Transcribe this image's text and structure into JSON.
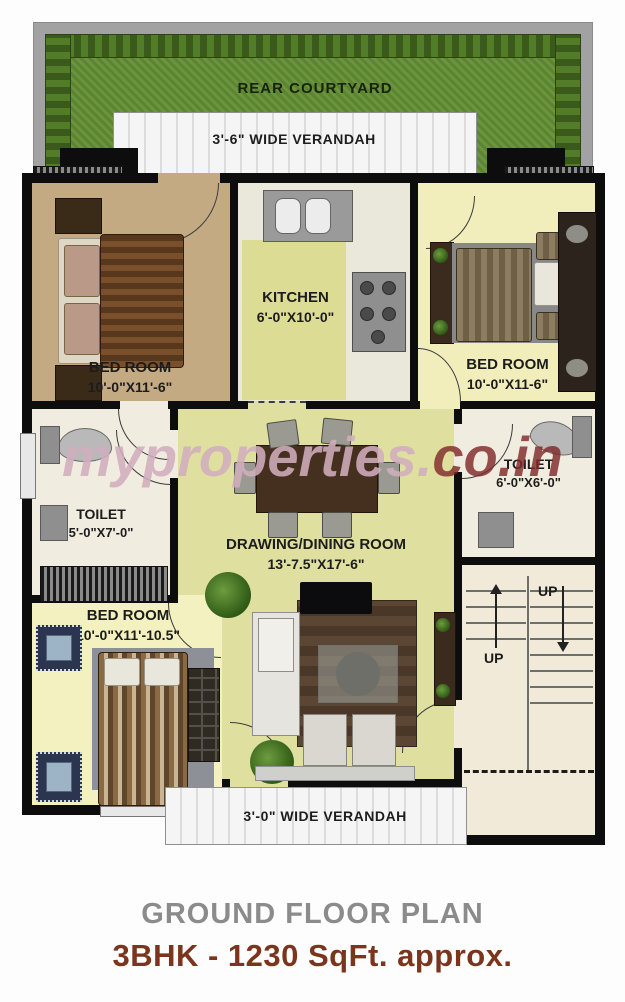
{
  "watermark": {
    "part1": "myproperties.",
    "part2": "co.in"
  },
  "rooms": {
    "rear_courtyard": {
      "name": "REAR COURTYARD"
    },
    "top_verandah": {
      "name": "3'-6\" WIDE VERANDAH"
    },
    "bottom_verandah": {
      "name": "3'-0\" WIDE VERANDAH"
    },
    "bedroom_top_left": {
      "name": "BED ROOM",
      "dims": "10'-0\"X11'-6\""
    },
    "kitchen": {
      "name": "KITCHEN",
      "dims": "6'-0\"X10'-0\""
    },
    "bedroom_top_right": {
      "name": "BED ROOM",
      "dims": "10'-0\"X11-6\""
    },
    "toilet_left": {
      "name": "TOILET",
      "dims": "5'-0\"X7'-0\""
    },
    "toilet_right": {
      "name": "TOILET",
      "dims": "6'-0\"X6'-0\""
    },
    "drawing_dining": {
      "name": "DRAWING/DINING ROOM",
      "dims": "13'-7.5\"X17'-6\""
    },
    "bedroom_bottom_left": {
      "name": "BED ROOM",
      "dims": "10'-0\"X11'-10.5\""
    },
    "stairs": {
      "up1": "UP",
      "up2": "UP"
    }
  },
  "footer": {
    "title": "GROUND FLOOR PLAN",
    "subtitle": "3BHK - 1230 SqFt. approx."
  },
  "colors": {
    "grass": "#67913a",
    "floor_tan": "#c3aa82",
    "floor_pale_yellow": "#f2eebb",
    "floor_yellow_green": "#dfe0a0",
    "floor_cream": "#f1ece0",
    "wall": "#0d0d0d",
    "title_gray": "#8b8b8b",
    "subtitle_brown": "#7c351d",
    "watermark_pink": "#d0adbd",
    "watermark_red": "#802a2a"
  }
}
